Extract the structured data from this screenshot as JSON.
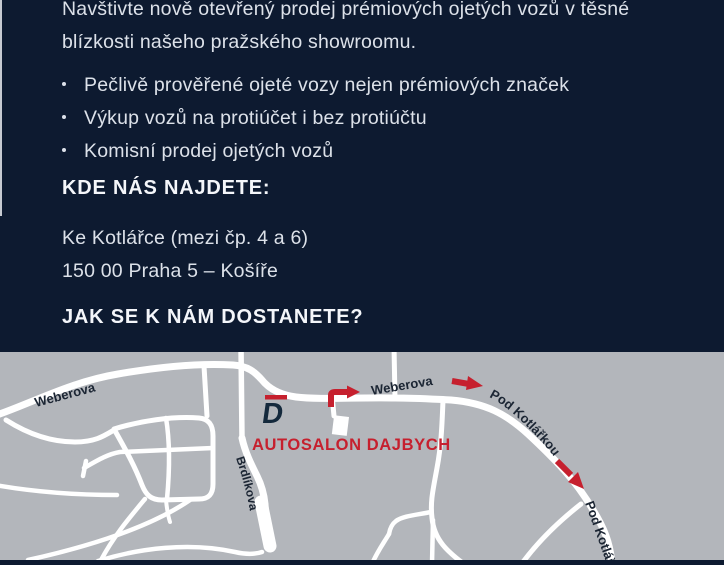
{
  "colors": {
    "bg_navy": "#0d1a30",
    "map_gray": "#b3b6bb",
    "road_white": "#ffffff",
    "accent_red": "#c6202e",
    "map_label_dark": "#1b2533",
    "body_text": "#dce1e9",
    "heading_text": "#f4f6fa"
  },
  "flyer": {
    "intro": "Navštivte nově otevřený prodej prémiových ojetých vozů v těsné blízkosti našeho pražského showroomu.",
    "bullets": [
      "Pečlivě prověřené ojeté vozy nejen prémiových značek",
      "Výkup vozů na protiúčet i bez protiúčtu",
      "Komisní prodej ojetých vozů"
    ],
    "where_heading": "KDE NÁS NAJDETE:",
    "address": [
      "Ke Kotlářce (mezi čp. 4 a 6)",
      "150 00 Praha 5 – Košíře"
    ],
    "how_heading": "JAK SE K NÁM DOSTANETE?"
  },
  "map": {
    "dealer_name": "AUTOSALON DAJBYCH",
    "logo_letter": "D",
    "streets": {
      "weberova_left": "Weberova",
      "weberova_center": "Weberova",
      "pod_kotlarkou_upper": "Pod Kotlářkou",
      "pod_kotlarkou_lower": "Pod Kotlářkou",
      "brdlikova": "Brdlíkova"
    },
    "icons": [
      "route-arrow-elbow-right",
      "route-arrow-right",
      "route-arrow-down-right"
    ]
  }
}
